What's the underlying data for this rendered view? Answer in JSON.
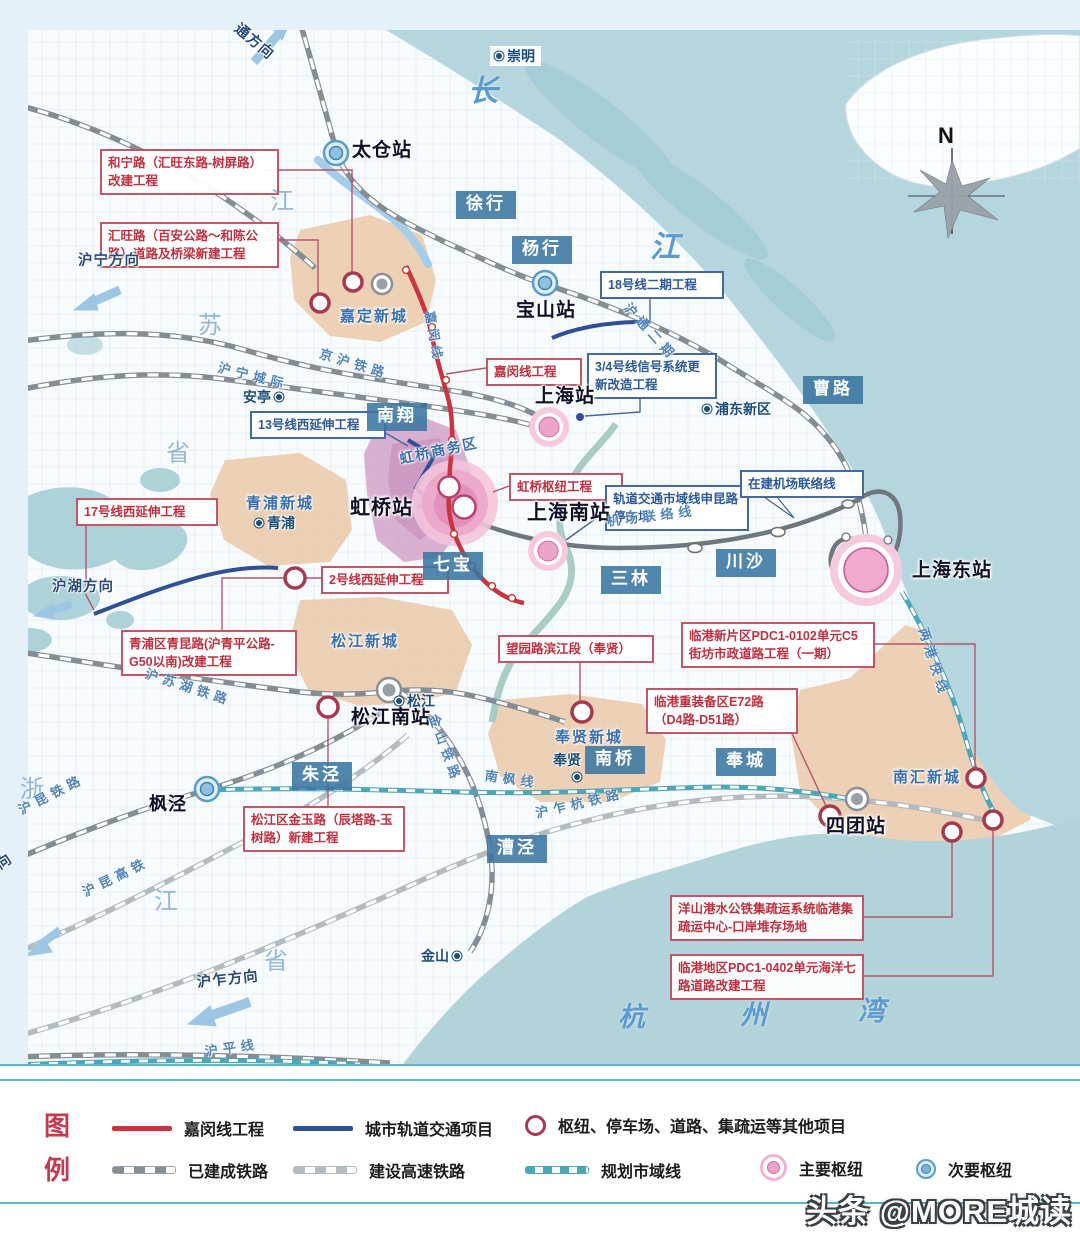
{
  "legend": {
    "heading": [
      "图",
      "例"
    ],
    "items": [
      {
        "label": "嘉闵线工程"
      },
      {
        "label": "城市轨道交通项目"
      },
      {
        "label": "枢纽、停车场、道路、集疏运等其他项目"
      },
      {
        "label": "已建成铁路"
      },
      {
        "label": "建设高速铁路"
      },
      {
        "label": "规划市域线"
      },
      {
        "label": "主要枢纽"
      },
      {
        "label": "次要枢纽"
      }
    ]
  },
  "watermark": "头条 @MORE城读",
  "colors": {
    "jiamin_line": "#cc3340",
    "urban_rail": "#2f4f96",
    "planned_line": "#4aa6b8",
    "other_project_ring": "#a63950",
    "major_hub": "#eda4c9",
    "minor_hub": "#79b3d6",
    "water": "#b5d6de",
    "new_town_zone": "#eac7a6",
    "hongqiao_zone": "#cf9ec6"
  },
  "overlays": [
    {
      "n": "callout-hening-road",
      "t": "red-box",
      "x": 100,
      "y": 149,
      "w": 163,
      "text": "和宁路（汇旺东路-树屏路）改建工程"
    },
    {
      "n": "callout-huiwang-road",
      "t": "red-box",
      "x": 100,
      "y": 222,
      "w": 163,
      "text": "汇旺路（百安公路～和陈公路）道路及桥梁新建工程"
    },
    {
      "n": "callout-jiamin-line",
      "t": "red-box",
      "x": 486,
      "y": 358,
      "w": 80,
      "text": "嘉闵线工程"
    },
    {
      "n": "callout-hongqiao-hub",
      "t": "red-box",
      "x": 509,
      "y": 473,
      "w": 98,
      "text": "虹桥枢纽工程"
    },
    {
      "n": "callout-line2-west",
      "t": "red-box",
      "x": 321,
      "y": 566,
      "w": 112,
      "text": "2号线西延伸工程"
    },
    {
      "n": "callout-line17-west",
      "t": "red-box",
      "x": 76,
      "y": 498,
      "w": 126,
      "text": "17号线西延伸工程"
    },
    {
      "n": "callout-qingkun-road",
      "t": "red-box",
      "x": 121,
      "y": 630,
      "w": 160,
      "text": "青浦区青昆路(沪青平公路-G50以南)改建工程"
    },
    {
      "n": "callout-jinyu-road",
      "t": "red-box",
      "x": 243,
      "y": 806,
      "w": 146,
      "text": "松江区金玉路（辰塔路-玉树路）新建工程"
    },
    {
      "n": "callout-wangyuan-road",
      "t": "red-box",
      "x": 498,
      "y": 635,
      "w": 140,
      "text": "望园路滨江段（奉贤）"
    },
    {
      "n": "callout-pdc1-0102",
      "t": "red-box",
      "x": 681,
      "y": 622,
      "w": 178,
      "text": "临港新片区PDC1-0102单元C5街坊市政道路工程（一期）"
    },
    {
      "n": "callout-e72-road",
      "t": "red-box",
      "x": 646,
      "y": 688,
      "w": 136,
      "text": "临港重装备区E72路（D4路-D51路）"
    },
    {
      "n": "callout-yangshan",
      "t": "red-box",
      "x": 670,
      "y": 895,
      "w": 178,
      "text": "洋山港水公铁集疏运系统临港集疏运中心-口岸堆存场地"
    },
    {
      "n": "callout-pdc1-0402",
      "t": "red-box",
      "x": 670,
      "y": 954,
      "w": 178,
      "text": "临港地区PDC1-0402单元海洋七路道路改建工程"
    },
    {
      "n": "callout-line18-phase2",
      "t": "blue-box",
      "x": 600,
      "y": 271,
      "w": 108,
      "text": "18号线二期工程"
    },
    {
      "n": "callout-line34-signal",
      "t": "blue-box",
      "x": 587,
      "y": 353,
      "w": 114,
      "text": "3/4号线信号系统更新改造工程"
    },
    {
      "n": "callout-line13-west",
      "t": "blue-box",
      "x": 250,
      "y": 411,
      "w": 120,
      "text": "13号线西延伸工程"
    },
    {
      "n": "callout-shenkun-depot",
      "t": "blue-box",
      "x": 605,
      "y": 485,
      "w": 128,
      "text": "轨道交通市域线申昆路停车场"
    },
    {
      "n": "callout-airport-link",
      "t": "blue-box",
      "x": 740,
      "y": 470,
      "w": 108,
      "text": "在建机场联络线"
    },
    {
      "n": "town-xuhang",
      "t": "town",
      "x": 456,
      "y": 191,
      "text": "徐行"
    },
    {
      "n": "town-yanghang",
      "t": "town",
      "x": 512,
      "y": 236,
      "text": "杨行"
    },
    {
      "n": "town-nanxiang",
      "t": "town",
      "x": 367,
      "y": 403,
      "text": "南翔"
    },
    {
      "n": "town-qibao",
      "t": "town",
      "x": 423,
      "y": 552,
      "text": "七宝"
    },
    {
      "n": "town-sanlin",
      "t": "town",
      "x": 601,
      "y": 566,
      "text": "三林"
    },
    {
      "n": "town-chuansha",
      "t": "town",
      "x": 716,
      "y": 549,
      "text": "川沙"
    },
    {
      "n": "town-caolu",
      "t": "town",
      "x": 803,
      "y": 376,
      "text": "曹路"
    },
    {
      "n": "town-zhujing",
      "t": "town",
      "x": 292,
      "y": 762,
      "text": "朱泾"
    },
    {
      "n": "town-nanqiao",
      "t": "town",
      "x": 585,
      "y": 746,
      "text": "南桥"
    },
    {
      "n": "town-fengcheng",
      "t": "town",
      "x": 716,
      "y": 748,
      "text": "奉城"
    },
    {
      "n": "town-caojing",
      "t": "town",
      "x": 487,
      "y": 835,
      "text": "漕泾"
    },
    {
      "n": "station-taicang",
      "t": "station",
      "x": 352,
      "y": 139,
      "text": "太仓站"
    },
    {
      "n": "station-baoshan",
      "t": "station",
      "x": 516,
      "y": 299,
      "text": "宝山站"
    },
    {
      "n": "station-shanghai",
      "t": "station",
      "x": 535,
      "y": 385,
      "text": "上海站"
    },
    {
      "n": "station-hongqiao",
      "t": "station",
      "x": 350,
      "y": 495,
      "text": "虹桥站",
      "fs": 20
    },
    {
      "n": "station-shanghai-south",
      "t": "station",
      "x": 527,
      "y": 500,
      "text": "上海南站",
      "fs": 20
    },
    {
      "n": "station-shanghai-east",
      "t": "station",
      "x": 912,
      "y": 559,
      "text": "上海东站"
    },
    {
      "n": "station-songjiang-south",
      "t": "station",
      "x": 351,
      "y": 706,
      "text": "松江南站"
    },
    {
      "n": "station-fengjing",
      "t": "station",
      "x": 149,
      "y": 793,
      "text": "枫泾",
      "fs": 18
    },
    {
      "n": "station-situan",
      "t": "station",
      "x": 826,
      "y": 815,
      "text": "四团站"
    },
    {
      "n": "area-jiading-newtown",
      "t": "area",
      "x": 340,
      "y": 307,
      "text": "嘉定新城"
    },
    {
      "n": "area-qingpu-newtown",
      "t": "area",
      "x": 246,
      "y": 494,
      "text": "青浦新城"
    },
    {
      "n": "area-songjiang-newtown",
      "t": "area",
      "x": 331,
      "y": 632,
      "text": "松江新城"
    },
    {
      "n": "area-fengxian-newtown",
      "t": "area",
      "x": 555,
      "y": 728,
      "text": "奉贤新城"
    },
    {
      "n": "area-nanhui-newtown",
      "t": "area",
      "x": 893,
      "y": 768,
      "text": "南汇新城"
    },
    {
      "n": "area-hongqiao-cbd",
      "t": "area",
      "x": 398,
      "y": 450,
      "text": "虹桥商务区",
      "r": -12,
      "fs": 14
    },
    {
      "n": "poi-chongming",
      "t": "poi-chip",
      "x": 490,
      "y": 46,
      "text": "崇明"
    },
    {
      "n": "poi-anting",
      "t": "poi-r",
      "x": 243,
      "y": 388,
      "text": "安亭"
    },
    {
      "n": "poi-qingpu",
      "t": "poi-l",
      "x": 256,
      "y": 514,
      "text": "青浦"
    },
    {
      "n": "poi-songjiang",
      "t": "poi-l",
      "x": 396,
      "y": 692,
      "text": "松江"
    },
    {
      "n": "poi-fengxian",
      "t": "poi",
      "x": 553,
      "y": 751,
      "text": "奉贤"
    },
    {
      "n": "poi-fengxian-dot",
      "t": "dot",
      "x": 574,
      "y": 774,
      "text": ""
    },
    {
      "n": "poi-jinshan",
      "t": "poi-r",
      "x": 421,
      "y": 947,
      "text": "金山"
    },
    {
      "n": "poi-pudong-new-area",
      "t": "poi-l",
      "x": 704,
      "y": 400,
      "text": "浦东新区"
    },
    {
      "n": "prov-jiangsu-jiang",
      "t": "prov",
      "x": 270,
      "y": 186,
      "text": "江"
    },
    {
      "n": "prov-jiangsu-su",
      "t": "prov",
      "x": 198,
      "y": 310,
      "text": "苏"
    },
    {
      "n": "prov-jiangsu-sheng",
      "t": "prov",
      "x": 166,
      "y": 438,
      "text": "省"
    },
    {
      "n": "prov-zhejiang-zhe",
      "t": "prov",
      "x": 20,
      "y": 774,
      "text": "浙"
    },
    {
      "n": "prov-zhejiang-jiang",
      "t": "prov",
      "x": 154,
      "y": 886,
      "text": "江"
    },
    {
      "n": "prov-zhejiang-sheng",
      "t": "prov",
      "x": 264,
      "y": 946,
      "text": "省"
    },
    {
      "n": "water-changjiang-chang",
      "t": "water",
      "x": 468,
      "y": 72,
      "text": "长",
      "fs": 30
    },
    {
      "n": "water-changjiang-jiang",
      "t": "water",
      "x": 650,
      "y": 228,
      "text": "江",
      "fs": 30
    },
    {
      "n": "water-hangzhouwan-hang",
      "t": "water",
      "x": 618,
      "y": 1000,
      "text": "杭",
      "fs": 27
    },
    {
      "n": "water-hangzhouwan-zhou",
      "t": "water",
      "x": 740,
      "y": 998,
      "text": "州",
      "fs": 27
    },
    {
      "n": "water-hangzhouwan-wan",
      "t": "water",
      "x": 858,
      "y": 994,
      "text": "湾",
      "fs": 27
    },
    {
      "n": "rail-label-jinghu",
      "t": "rail",
      "x": 322,
      "y": 346,
      "text": "京沪铁路",
      "r": 17
    },
    {
      "n": "rail-label-huning-intercity",
      "t": "rail",
      "x": 220,
      "y": 360,
      "text": "沪宁城际",
      "r": 14
    },
    {
      "n": "rail-label-hutong-phase2",
      "t": "rail",
      "x": 632,
      "y": 300,
      "text": "沪通二期",
      "r": 48
    },
    {
      "n": "rail-label-jiamin",
      "t": "rail",
      "x": 437,
      "y": 310,
      "text": "嘉闵线",
      "r": 80,
      "fs": 12.5
    },
    {
      "n": "rail-label-airport-link",
      "t": "rail",
      "x": 606,
      "y": 514,
      "text": "机场联络线",
      "r": -7
    },
    {
      "n": "rail-label-husuhu",
      "t": "rail",
      "x": 148,
      "y": 666,
      "text": "沪苏湖铁路",
      "r": 18
    },
    {
      "n": "rail-label-jinshan",
      "t": "rail",
      "x": 440,
      "y": 712,
      "text": "金山铁路",
      "r": 70
    },
    {
      "n": "rail-label-nanfeng",
      "t": "rail",
      "x": 486,
      "y": 768,
      "text": "南枫线",
      "r": 8
    },
    {
      "n": "rail-label-huzhahang",
      "t": "rail",
      "x": 534,
      "y": 806,
      "text": "沪乍杭铁路",
      "r": -13
    },
    {
      "n": "rail-label-hukun",
      "t": "rail",
      "x": 16,
      "y": 804,
      "text": "沪昆铁路",
      "r": -27
    },
    {
      "n": "rail-label-hukun-hsr",
      "t": "rail",
      "x": 80,
      "y": 886,
      "text": "沪昆高铁",
      "r": -26
    },
    {
      "n": "rail-label-huping",
      "t": "rail",
      "x": 204,
      "y": 1044,
      "text": "沪平线",
      "r": -8
    },
    {
      "n": "rail-label-lianggang",
      "t": "rail",
      "x": 930,
      "y": 626,
      "text": "两港快线",
      "r": 72
    },
    {
      "n": "dir-nantong",
      "t": "dir",
      "x": 242,
      "y": 20,
      "text": "通方向",
      "r": 40
    },
    {
      "n": "dir-huning",
      "t": "dir",
      "x": 78,
      "y": 252,
      "text": "沪宁方向"
    },
    {
      "n": "dir-huhu",
      "t": "dir",
      "x": 52,
      "y": 578,
      "text": "沪湖方向"
    },
    {
      "n": "dir-hukun",
      "t": "dir",
      "x": -46,
      "y": 884,
      "text": "沪昆方向",
      "r": -33
    },
    {
      "n": "dir-huzha",
      "t": "dir",
      "x": 196,
      "y": 974,
      "text": "沪乍方向",
      "r": -6
    },
    {
      "n": "compass-n",
      "t": "compass",
      "x": 938,
      "y": 122,
      "text": "N"
    }
  ]
}
